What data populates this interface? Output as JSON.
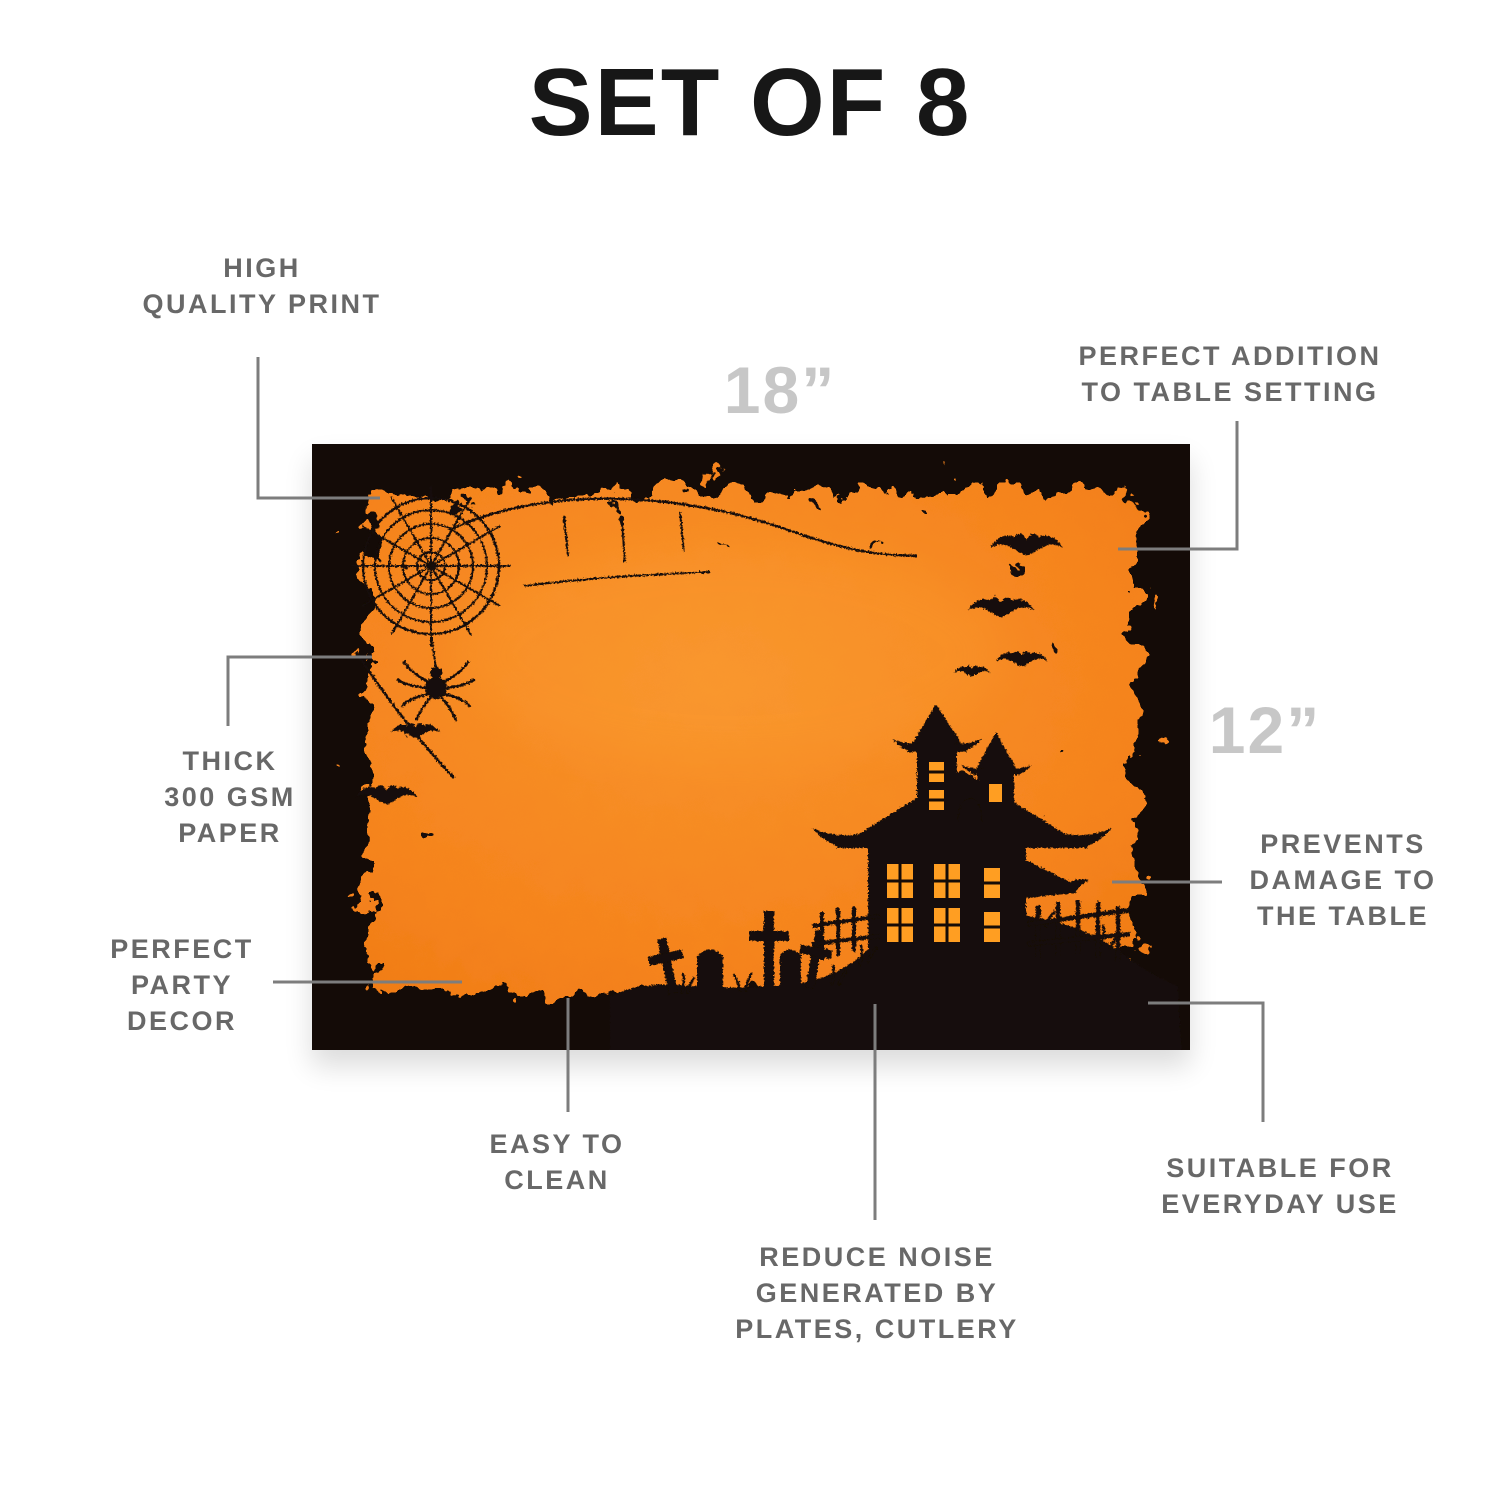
{
  "title": "SET OF 8",
  "dimension_labels": {
    "width": "18”",
    "height": "12”"
  },
  "callouts": {
    "high_quality_print": [
      "HIGH",
      "QUALITY PRINT"
    ],
    "perfect_addition": [
      "PERFECT ADDITION",
      "TO TABLE SETTING"
    ],
    "thick_paper": [
      "THICK",
      "300 GSM",
      "PAPER"
    ],
    "perfect_party_decor": [
      "PERFECT",
      "PARTY",
      "DECOR"
    ],
    "prevents_damage": [
      "PREVENTS",
      "DAMAGE TO",
      "THE TABLE"
    ],
    "easy_to_clean": [
      "EASY TO",
      "CLEAN"
    ],
    "reduce_noise": [
      "REDUCE NOISE",
      "GENERATED BY",
      "PLATES, CUTLERY"
    ],
    "suitable_everyday": [
      "SUITABLE FOR",
      "EVERYDAY USE"
    ]
  },
  "placemat": {
    "theme": "halloween-haunted-house-graveyard",
    "motifs": [
      "spider-web",
      "spider",
      "bats",
      "haunted-house",
      "tombstones",
      "crosses",
      "fence",
      "grunge-border"
    ]
  },
  "colors": {
    "orange": "#f6861f",
    "mat_black": "#140b07",
    "window_glow": "#ff9e22",
    "label_gray": "#686868",
    "dimension_gray": "#c7c7c7",
    "line_gray": "#7d7d7d",
    "title_black": "#171717"
  }
}
